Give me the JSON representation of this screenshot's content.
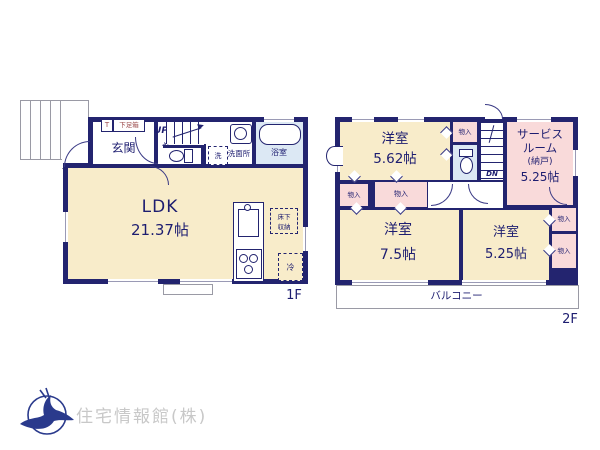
{
  "floor1": {
    "floor_label": "1F",
    "entrance": "玄関",
    "shoe_t": "T",
    "shoe_box": "下足箱",
    "up": "UP",
    "hall": "ホール",
    "washer": "洗",
    "washroom": "洗面所",
    "bathroom": "浴室",
    "ldk": "LDK",
    "ldk_size": "21.37帖",
    "underfloor_1": "床下",
    "underfloor_2": "収納",
    "fridge": "冷"
  },
  "floor2": {
    "floor_label": "2F",
    "bedroom1": "洋室",
    "bedroom1_size": "5.62帖",
    "closet_top": "物入",
    "dn": "DN",
    "service_line1": "サービス",
    "service_line2": "ルーム",
    "service_line3": "(納戸)",
    "service_size": "5.25帖",
    "closet_left_a": "物入",
    "closet_left_b": "物入",
    "bedroom2": "洋室",
    "bedroom2_size": "7.5帖",
    "bedroom3": "洋室",
    "bedroom3_size": "5.25帖",
    "closet_right_a": "物入",
    "closet_right_b": "物入",
    "balcony": "バルコニー"
  },
  "footer": {
    "company": "住宅情報館(株)"
  },
  "colors": {
    "wall": "#23246f",
    "room_cream": "#f8ecca",
    "room_pink": "#f9dada",
    "room_blue": "#dce8f4",
    "logo_blue": "#2a3a8c",
    "shoebox_text": "#9b4a4a"
  }
}
